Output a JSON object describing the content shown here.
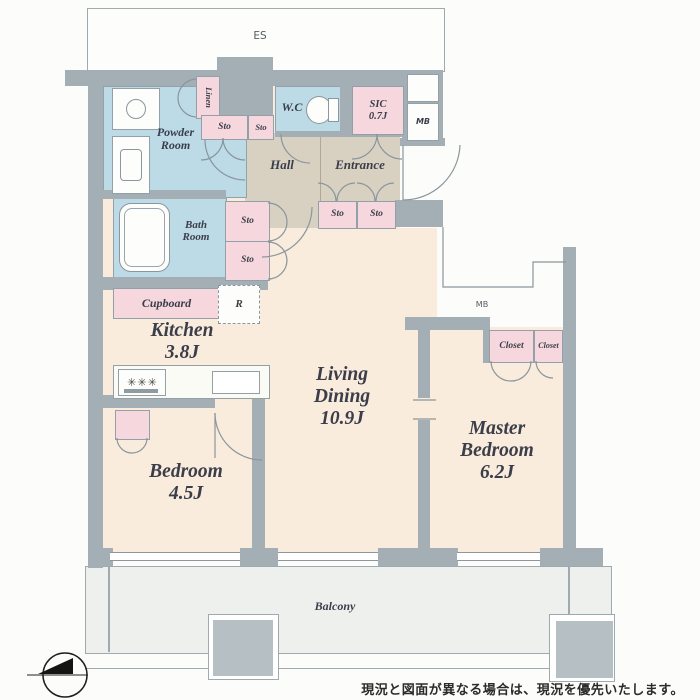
{
  "disclaimer": "現況と図面が異なる場合は、現況を優先いたします。",
  "labels": {
    "es": "ES",
    "powder_room": "Powder\nRoom",
    "linen": "Linen",
    "sto": "Sto",
    "wc": "W.C",
    "sic": "SIC\n0.7J",
    "mb": "MB",
    "hall": "Hall",
    "entrance": "Entrance",
    "bath_room": "Bath\nRoom",
    "cupboard": "Cupboard",
    "refrigerator": "R",
    "kitchen": "Kitchen\n3.8J",
    "living_dining": "Living\nDining\n10.9J",
    "bedroom": "Bedroom\n4.5J",
    "master_bedroom": "Master\nBedroom\n6.2J",
    "closet": "Closet",
    "balcony": "Balcony"
  },
  "colors": {
    "wall": "#a3aeb5",
    "floor": "#f9ecdd",
    "wet_area": "#bcdbe7",
    "storage": "#f5d7dd",
    "hall_entrance": "#d8d1c2",
    "balcony": "#eef0ee",
    "equipment": "#b6bfc3"
  }
}
